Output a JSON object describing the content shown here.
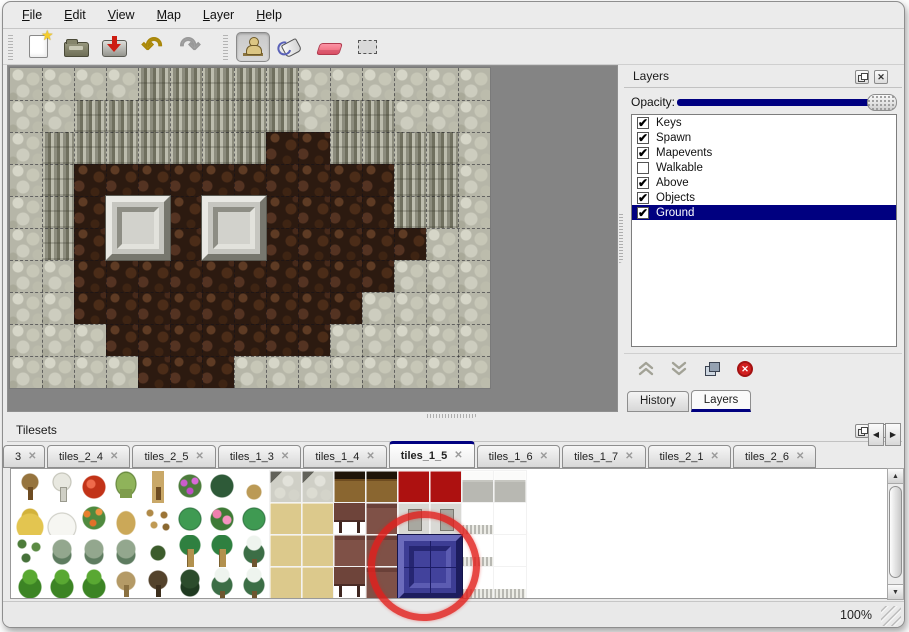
{
  "colors": {
    "accent_navy": "#000080",
    "window_bg": "#ebebeb",
    "map_bg": "#848484",
    "annotation_red": "#e2201c"
  },
  "glyphs": {
    "star": "★",
    "undo": "↶",
    "redo": "↷",
    "check": "✔",
    "close": "✕",
    "tab_close": "✕",
    "delete_x": "✕",
    "arrow_up": "▲",
    "arrow_down": "▼",
    "arrow_left": "◀",
    "arrow_right": "▶"
  },
  "menu": {
    "items": [
      {
        "label": "File"
      },
      {
        "label": "Edit"
      },
      {
        "label": "View"
      },
      {
        "label": "Map"
      },
      {
        "label": "Layer"
      },
      {
        "label": "Help"
      }
    ]
  },
  "toolbar": {
    "buttons": [
      {
        "name": "new-map-button",
        "icon": "new-file-icon",
        "pressed": false
      },
      {
        "name": "open-map-button",
        "icon": "open-folder-icon",
        "pressed": false
      },
      {
        "name": "save-map-button",
        "icon": "save-icon",
        "pressed": false
      },
      {
        "name": "undo-button",
        "icon": "undo-icon",
        "pressed": false
      },
      {
        "name": "redo-button",
        "icon": "redo-icon",
        "pressed": false
      },
      {
        "name": "stamp-tool-button",
        "icon": "stamp-icon",
        "pressed": true
      },
      {
        "name": "fill-tool-button",
        "icon": "paint-bucket-icon",
        "pressed": false
      },
      {
        "name": "eraser-tool-button",
        "icon": "eraser-icon",
        "pressed": false
      },
      {
        "name": "select-tool-button",
        "icon": "marquee-selection-icon",
        "pressed": false
      }
    ]
  },
  "map": {
    "tile_size": 32,
    "legend": {
      "S": "scaly-stone",
      "C": "cliff-wall",
      "F": "dark-floor"
    },
    "grid": [
      "SSSSCCCCCSSSSSS",
      "SSCCCCCCCSCCSSS",
      "SCCCCCCCFFCCCCS",
      "SCFFFFFFFFFFCCS",
      "SCFFFFFFFFFFCCS",
      "SCFFFFFFFFFFFSS",
      "SSFFFFFFFFFFSSS",
      "SSFFFFFFFFFSSSS",
      "SSSFFFFFFFSSSSS",
      "SSSSFFFSSSSSSSS"
    ],
    "blocks": [
      {
        "col": 3,
        "row": 4
      },
      {
        "col": 6,
        "row": 4
      }
    ]
  },
  "layers_panel": {
    "title": "Layers",
    "float_icon": "float-window-icon",
    "close_icon": "close-icon",
    "opacity_label": "Opacity:",
    "opacity_value_pct": 100,
    "layers": [
      {
        "name": "Keys",
        "checked": true,
        "selected": false
      },
      {
        "name": "Spawn",
        "checked": true,
        "selected": false
      },
      {
        "name": "Mapevents",
        "checked": true,
        "selected": false
      },
      {
        "name": "Walkable",
        "checked": false,
        "selected": false
      },
      {
        "name": "Above",
        "checked": true,
        "selected": false
      },
      {
        "name": "Objects",
        "checked": true,
        "selected": false
      },
      {
        "name": "Ground",
        "checked": true,
        "selected": true
      }
    ],
    "action_buttons": [
      {
        "name": "move-layer-up-button",
        "icon": "chevron-up-icon"
      },
      {
        "name": "move-layer-down-button",
        "icon": "chevron-down-icon"
      },
      {
        "name": "duplicate-layer-button",
        "icon": "duplicate-icon"
      },
      {
        "name": "delete-layer-button",
        "icon": "delete-circle-icon"
      }
    ],
    "bottom_tabs": [
      {
        "label": "History",
        "active": false
      },
      {
        "label": "Layers",
        "active": true
      }
    ]
  },
  "tilesets_panel": {
    "title": "Tilesets",
    "float_icon": "float-window-icon",
    "close_icon": "close-icon",
    "tabs": [
      {
        "label": "3",
        "active": false,
        "cut": true
      },
      {
        "label": "tiles_2_4",
        "active": false
      },
      {
        "label": "tiles_2_5",
        "active": false
      },
      {
        "label": "tiles_1_3",
        "active": false
      },
      {
        "label": "tiles_1_4",
        "active": false
      },
      {
        "label": "tiles_1_5",
        "active": true
      },
      {
        "label": "tiles_1_6",
        "active": false
      },
      {
        "label": "tiles_1_7",
        "active": false
      },
      {
        "label": "tiles_2_1",
        "active": false
      },
      {
        "label": "tiles_2_6",
        "active": false
      }
    ],
    "grid_rows": [
      [
        "treeBare",
        "treeSnowBare",
        "flowerRed",
        "stump",
        "trunk",
        "bushPurple",
        "fern",
        "sproutTan",
        "cobble",
        "cobble",
        "wood",
        "wood",
        "carpetRed",
        "carpetRed",
        "grayTile",
        "grayTile"
      ],
      [
        "hay",
        "snowMound",
        "flowersOrange",
        "tuft",
        "leaves",
        "lily",
        "flowersPink",
        "lily",
        "carpetTan",
        "carpetTan",
        "maroonLeg",
        "maroon",
        "metal",
        "metal",
        "whiteFringe",
        "white"
      ],
      [
        "sprigs",
        "bush",
        "bush",
        "bush",
        "sprigDark",
        "palm",
        "palm",
        "pineSnow",
        "carpetTan",
        "carpetTan",
        "maroon",
        "maroon",
        "blue",
        "blue",
        "whiteFringe",
        "white"
      ],
      [
        "treeGreen",
        "treeGreen",
        "treeGreen",
        "treeDead",
        "treeDarkDead",
        "treeDark",
        "pineSnow",
        "pineSnow",
        "carpetTan",
        "carpetTan",
        "maroonLeg",
        "maroon",
        "blue",
        "blue",
        "whiteFringe",
        "whiteFringe"
      ]
    ],
    "selected_tile": {
      "col": 12,
      "row": 2,
      "span_cols": 2,
      "span_rows": 2,
      "color": "#3d3d94"
    },
    "annotation": {
      "type": "red-circle"
    }
  },
  "statusbar": {
    "zoom": "100%"
  }
}
